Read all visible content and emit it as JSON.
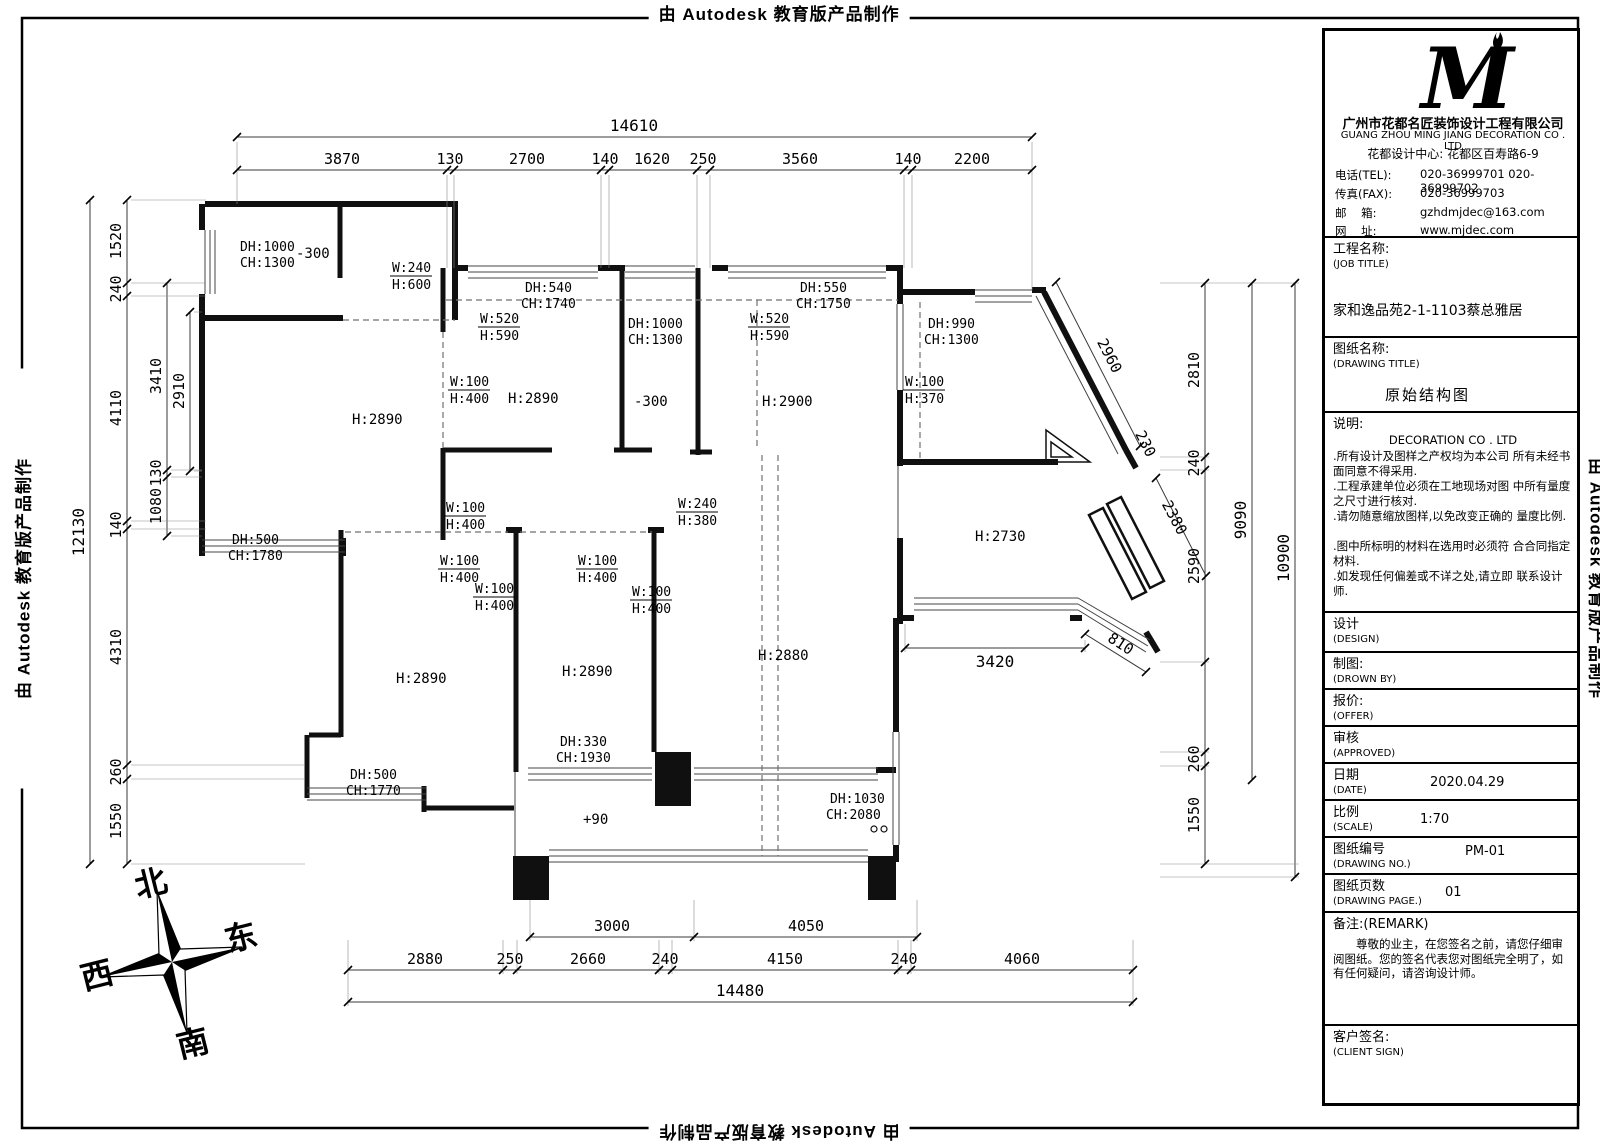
{
  "banner": "由 Autodesk 教育版产品制作",
  "company": {
    "logo_letter": "M",
    "name_cn": "广州市花都名匠装饰设计工程有限公司",
    "name_en": "GUANG ZHOU MING JIANG DECORATION CO . LTD",
    "center_line": "花都设计中心: 花都区百寿路6-9",
    "tel_label": "电话(TEL):",
    "tel_value": "020-36999701  020-36999702",
    "fax_label": "传真(FAX):",
    "fax_value": "020-36999703",
    "email_label": "邮    箱:",
    "email_value": "gzhdmjdec@163.com",
    "web_label": "网    址:",
    "web_value": "www.mjdec.com"
  },
  "fields": {
    "job_label_cn": "工程名称:",
    "job_label_en": "(JOB TITLE)",
    "job_value": "家和逸品苑2-1-1103蔡总雅居",
    "drawing_label_cn": "图纸名称:",
    "drawing_label_en": "(DRAWING TITLE)",
    "drawing_value": "原始结构图",
    "notes_label": "说明:",
    "notes_co": "DECORATION CO . LTD",
    "notes": [
      ".所有设计及图样之产权均为本公司 所有未经书面同意不得采用.",
      ".工程承建单位必须在工地现场对图 中所有量度之尺寸进行核对.",
      ".请勿随意缩放图样,以免改变正确的 量度比例.",
      ".图中所标明的材料在选用时必须符 合合同指定材料.",
      ".如发现任何偏差或不详之处,请立即 联系设计师."
    ],
    "design_cn": "设计",
    "design_en": "(DESIGN)",
    "drown_cn": "制图:",
    "drown_en": "(DROWN BY)",
    "offer_cn": "报价:",
    "offer_en": "(OFFER)",
    "approved_cn": "审核",
    "approved_en": "(APPROVED)",
    "date_cn": "日期",
    "date_en": "(DATE)",
    "date_value": "2020.04.29",
    "scale_cn": "比例",
    "scale_en": "(SCALE)",
    "scale_value": "1:70",
    "no_cn": "图纸编号",
    "no_en": "(DRAWING NO.)",
    "no_value": "PM-01",
    "page_cn": "图纸页数",
    "page_en": "(DRAWING PAGE.)",
    "page_value": "01",
    "remark_label": "备注:(REMARK)",
    "remark_text": "尊敬的业主，在您签名之前，请您仔细审阅图纸。您的签名代表您对图纸完全明了，如有任何疑问，请咨询设计师。",
    "sign_cn": "客户签名:",
    "sign_en": "(CLIENT SIGN)"
  },
  "compass": {
    "n": "北",
    "e": "东",
    "s": "南",
    "w": "西"
  },
  "dims": {
    "top_total": "14610",
    "top": [
      "3870",
      "130",
      "2700",
      "140",
      "1620",
      "250",
      "3560",
      "140",
      "2200"
    ],
    "left_total": "12130",
    "left": [
      "1520",
      "240",
      "4110",
      "140",
      "4310",
      "260",
      "1550"
    ],
    "left_inner": [
      "3410",
      "130",
      "1080"
    ],
    "left_inner2": "2910",
    "right": [
      "2810",
      "240",
      "2590",
      "260",
      "1550"
    ],
    "right_mid": "9090",
    "right_total": "10900",
    "diag": [
      "2960",
      "230",
      "2380",
      "810"
    ],
    "interior": "3420",
    "bottom_inner": [
      "3000",
      "4050"
    ],
    "bottom": [
      "2880",
      "250",
      "2660",
      "240",
      "4150",
      "240",
      "4060"
    ],
    "bottom_total": "14480"
  },
  "plan": {
    "rooms": [
      "H:2890",
      "H:2890",
      "H:2900",
      "H:2730",
      "H:2890",
      "H:2890",
      "H:2880"
    ],
    "levels": [
      "-300",
      "-300",
      "+90"
    ],
    "openings": [
      {
        "w": "W:240",
        "h": "H:600"
      },
      {
        "w": "W:520",
        "h": "H:590"
      },
      {
        "w": "W:520",
        "h": "H:590"
      },
      {
        "w": "W:100",
        "h": "H:400"
      },
      {
        "w": "W:100",
        "h": "H:370"
      },
      {
        "w": "W:100",
        "h": "H:400"
      },
      {
        "w": "W:240",
        "h": "H:380"
      },
      {
        "w": "W:100",
        "h": "H:400"
      },
      {
        "w": "W:100",
        "h": "H:400"
      },
      {
        "w": "W:100",
        "h": "H:400"
      },
      {
        "w": "W:100",
        "h": "H:400"
      }
    ],
    "windows": [
      {
        "dh": "DH:1000",
        "ch": "CH:1300"
      },
      {
        "dh": "DH:540",
        "ch": "CH:1740"
      },
      {
        "dh": "DH:1000",
        "ch": "CH:1300"
      },
      {
        "dh": "DH:550",
        "ch": "CH:1750"
      },
      {
        "dh": "DH:990",
        "ch": "CH:1300"
      },
      {
        "dh": "DH:500",
        "ch": "CH:1780"
      },
      {
        "dh": "DH:500",
        "ch": "CH:1770"
      },
      {
        "dh": "DH:330",
        "ch": "CH:1930"
      },
      {
        "dh": "DH:1030",
        "ch": "CH:2080"
      }
    ]
  }
}
